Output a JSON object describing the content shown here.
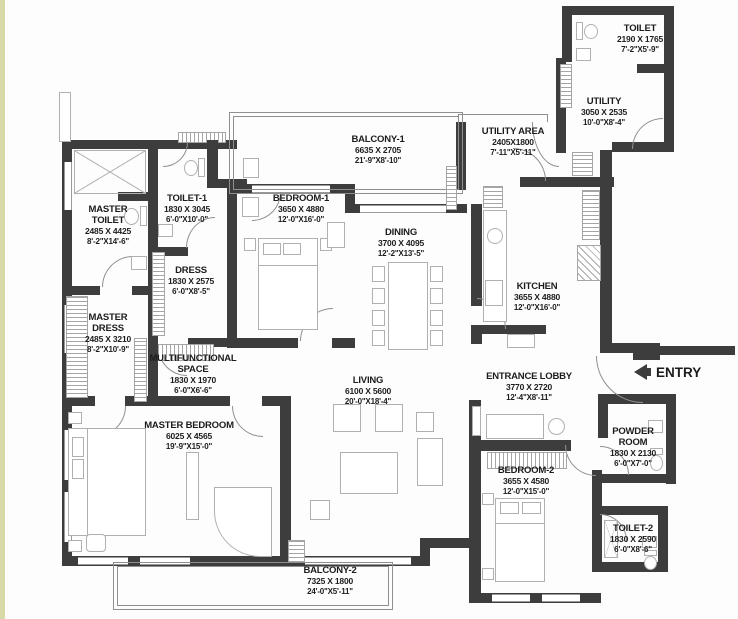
{
  "plan": {
    "entry": {
      "label": "ENTRY"
    },
    "rooms": [
      {
        "id": "toilet",
        "name": "TOILET",
        "metric": "2190 X 1765",
        "imperial": "7'-2\"X5'-9\""
      },
      {
        "id": "utility",
        "name": "UTILITY",
        "metric": "3050 X 2535",
        "imperial": "10'-0\"X8'-4\""
      },
      {
        "id": "balcony-1",
        "name": "BALCONY-1",
        "metric": "6635 X 2705",
        "imperial": "21'-9\"X8'-10\""
      },
      {
        "id": "utility-area",
        "name": "UTILITY AREA",
        "metric": "2405X1800",
        "imperial": "7'-11\"X5'-11\""
      },
      {
        "id": "toilet-1",
        "name": "TOILET-1",
        "metric": "1830 X 3045",
        "imperial": "6'-0\"X10'-0\""
      },
      {
        "id": "bedroom-1",
        "name": "BEDROOM-1",
        "metric": "3650 X 4880",
        "imperial": "12'-0\"X16'-0\""
      },
      {
        "id": "master-toilet",
        "name": "MASTER TOILET",
        "metric": "2485 X 4425",
        "imperial": "8'-2\"X14'-6\""
      },
      {
        "id": "dining",
        "name": "DINING",
        "metric": "3700 X 4095",
        "imperial": "12'-2\"X13'-5\""
      },
      {
        "id": "dress",
        "name": "DRESS",
        "metric": "1830 X 2575",
        "imperial": "6'-0\"X8'-5\""
      },
      {
        "id": "kitchen",
        "name": "KITCHEN",
        "metric": "3655 X 4880",
        "imperial": "12'-0\"X16'-0\""
      },
      {
        "id": "master-dress",
        "name": "MASTER DRESS",
        "metric": "2485 X 3210",
        "imperial": "8'-2\"X10'-9\""
      },
      {
        "id": "multifunctional",
        "name": "MULTIFUNCTIONAL SPACE",
        "metric": "1830 X 1970",
        "imperial": "6'-0\"X6'-6\""
      },
      {
        "id": "living",
        "name": "LIVING",
        "metric": "6100 X 5600",
        "imperial": "20'-0\"X18'-4\""
      },
      {
        "id": "entrance-lobby",
        "name": "ENTRANCE LOBBY",
        "metric": "3770 X 2720",
        "imperial": "12'-4\"X8'-11\""
      },
      {
        "id": "master-bedroom",
        "name": "MASTER BEDROOM",
        "metric": "6025 X 4565",
        "imperial": "19'-9\"X15'-0\""
      },
      {
        "id": "bedroom-2",
        "name": "BEDROOM-2",
        "metric": "3655 X 4580",
        "imperial": "12'-0\"X15'-0\""
      },
      {
        "id": "powder-room",
        "name": "POWDER ROOM",
        "metric": "1830 X 2130",
        "imperial": "6'-0\"X7'-0\""
      },
      {
        "id": "toilet-2",
        "name": "TOILET-2",
        "metric": "1830 X 2590",
        "imperial": "6'-0\"X8'-6\""
      },
      {
        "id": "balcony-2",
        "name": "BALCONY-2",
        "metric": "7325 X 1800",
        "imperial": "24'-0\"X5'-11\""
      }
    ],
    "colors": {
      "wall": "#3d3d3d",
      "furniture_line": "#b0b0b0",
      "balcony_line": "#8f8f8f",
      "text": "#1c1c1c",
      "page_edge": "#d7d9a6"
    }
  }
}
